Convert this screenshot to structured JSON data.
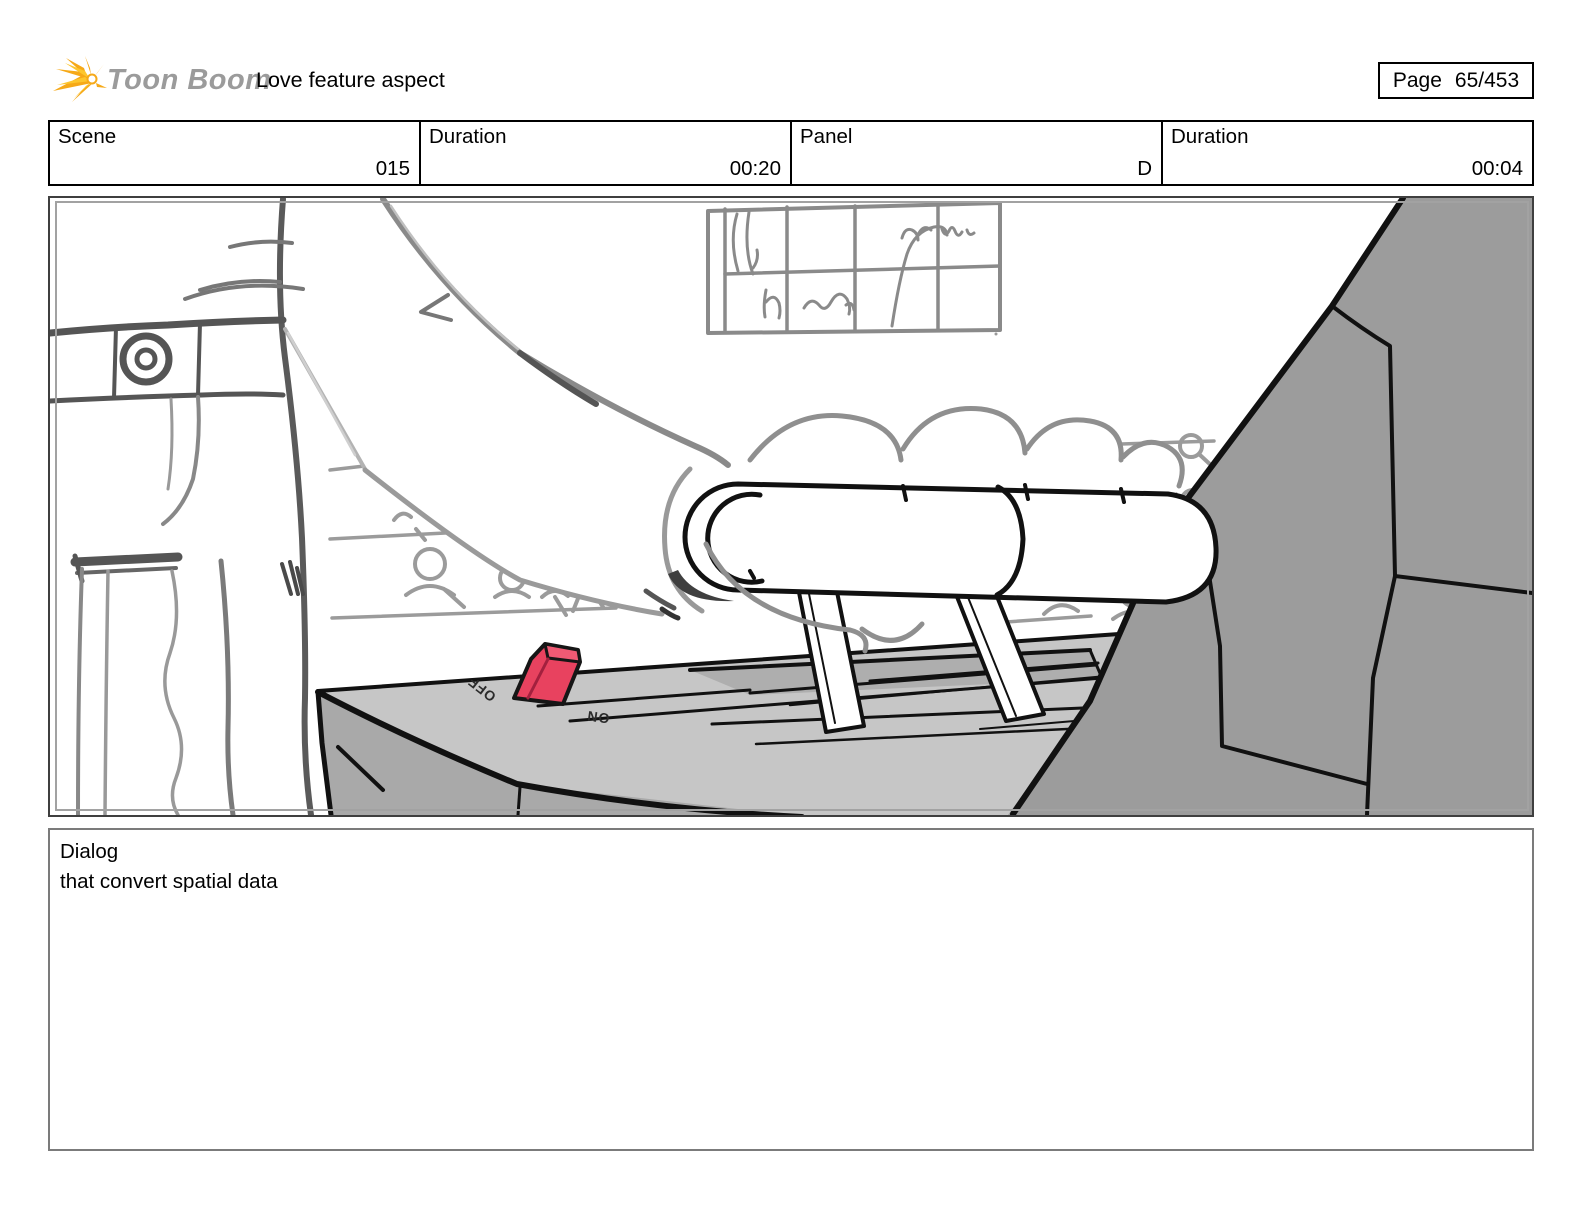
{
  "header": {
    "logo_text": "Toon Boom",
    "title": "Love feature aspect",
    "page_label": "Page",
    "page_value": "65/453"
  },
  "info_row": {
    "cells": [
      {
        "label": "Scene",
        "value": "015"
      },
      {
        "label": "Duration",
        "value": "00:20"
      },
      {
        "label": "Panel",
        "value": "D"
      },
      {
        "label": "Duration",
        "value": "00:04"
      }
    ]
  },
  "storyboard_panel": {
    "description": "Hand-drawn storyboard sketch: a hand grips a throttle lever set into a gray console with a red ON/OFF toggle switch; sketched crowd rows and a paned window in the background; large angular gray machine wall on the right.",
    "switch_off_label": "OFF",
    "switch_on_label": "ON"
  },
  "dialog": {
    "label": "Dialog",
    "text": "that convert spatial data"
  },
  "colors": {
    "switch_red": "#e8425f",
    "switch_red_top": "#f05a74",
    "console_top_gray": "#c6c6c6",
    "console_front_gray": "#a9a9a9",
    "machine_gray": "#9c9c9c",
    "sketch_gray": "#9b9b9b",
    "logo_yellow": "#f6a918",
    "logo_text_gray": "#9b9b9b"
  }
}
